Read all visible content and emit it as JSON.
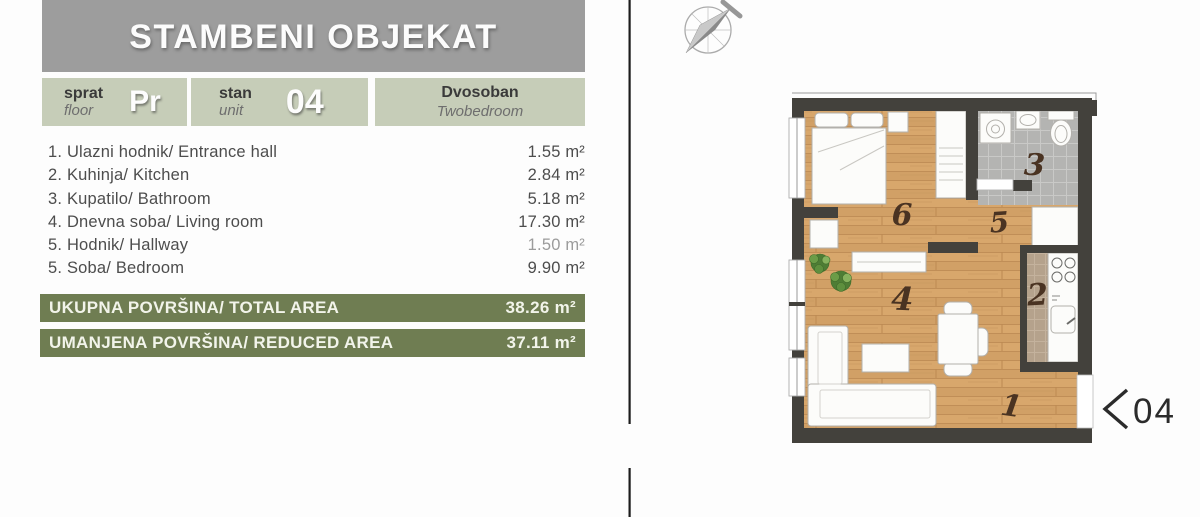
{
  "title": "STAMBENI OBJEKAT",
  "info": {
    "floor_label": "sprat",
    "floor_label_en": "floor",
    "floor_value": "Pr",
    "unit_label": "stan",
    "unit_label_en": "unit",
    "unit_value": "04",
    "type_label": "Dvosoban",
    "type_label_en": "Twobedroom"
  },
  "rooms": [
    {
      "name": "1. Ulazni hodnik/ Entrance hall",
      "area": "1.55 m²"
    },
    {
      "name": "2. Kuhinja/ Kitchen",
      "area": "2.84 m²"
    },
    {
      "name": "3. Kupatilo/ Bathroom",
      "area": "5.18 m²"
    },
    {
      "name": "4. Dnevna soba/ Living room",
      "area": "17.30 m²"
    },
    {
      "name": "5. Hodnik/ Hallway",
      "area": "1.50 m²"
    },
    {
      "name": "5. Soba/ Bedroom",
      "area": "9.90 m²"
    }
  ],
  "totals": {
    "total_label": "UKUPNA POVRŠINA/ TOTAL AREA",
    "total_value": "38.26 m²",
    "reduced_label": "UMANJENA POVRŠINA/ REDUCED AREA",
    "reduced_value": "37.11 m²"
  },
  "plan": {
    "labels": {
      "entrance_hall": "1",
      "kitchen": "2",
      "bathroom": "3",
      "living": "4",
      "hallway": "5",
      "bedroom": "6"
    },
    "entrance_unit": "04"
  },
  "icons": {
    "north_arrow": "compass-north-arrow"
  },
  "colors": {
    "header_gray": "#9d9d9d",
    "sage": "#c6cdb8",
    "olive": "#6f7d52",
    "wall": "#43413c",
    "wood": "#d8a76c",
    "bath_tile": "#b4b4b2",
    "kitchen_tile": "#b5a28c"
  }
}
